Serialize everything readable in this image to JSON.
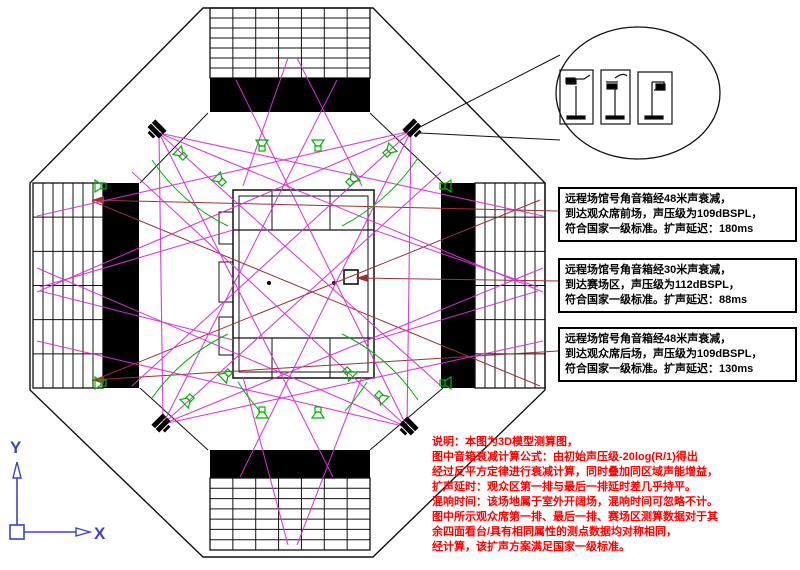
{
  "drawing": {
    "type": "stadium-sound-coverage-plan",
    "annotation_boxes": [
      {
        "lines": [
          "远程场馆号角音箱经48米声衰减，",
          "到达观众席前场，声压级为109dBSPL，",
          "符合国家一级标准。扩声延迟：180ms"
        ]
      },
      {
        "lines": [
          "远程场馆号角音箱经30米声衰减，",
          "到达赛场区，声压级为112dBSPL，",
          "符合国家一级标准。扩声延迟：88ms"
        ]
      },
      {
        "lines": [
          "远程场馆号角音箱经48米声衰减，",
          "到达观众席后场，声压级为109dBSPL，",
          "符合国家一级标准。扩声延迟：130ms"
        ]
      }
    ],
    "notes": {
      "lines": [
        "说明：本图为3D模型测算图，",
        "图中音箱衰减计算公式：由初始声压级-20log(R/1)得出",
        "经过反平方定律进行衰减计算，同时叠加同区域声能增益，",
        "扩声延时：观众区第一排与最后一排延时差几乎持平。",
        "混响时间：该场地属于室外开阔场，混响时间可忽略不计。",
        "图中所示观众席第一排、最后一排、赛场区测算数据对于其",
        "余四面看台/具有相同属性的测点数据均对称相同，",
        "经计算，该扩声方案满足国家一级标准。"
      ]
    },
    "axis_icon": {
      "x_label": "X",
      "y_label": "Y"
    },
    "icons": {
      "horn-speaker-icon": "green outlined horn loudspeaker glyph",
      "speaker-cluster-icon": "black stacked speaker cluster on 45° corner",
      "detail-callout-circle": "balloon with 3 speaker mounting detail panels",
      "ucs-axis-icon": "AutoCAD XY user coordinate system arrows"
    },
    "colors": {
      "coverage": "#d52fd5",
      "leader": "#993333",
      "speaker": "#00b400",
      "axis": "#4040c4",
      "note": "#ff0000",
      "ink": "#000000",
      "background": "#ffffff"
    }
  }
}
